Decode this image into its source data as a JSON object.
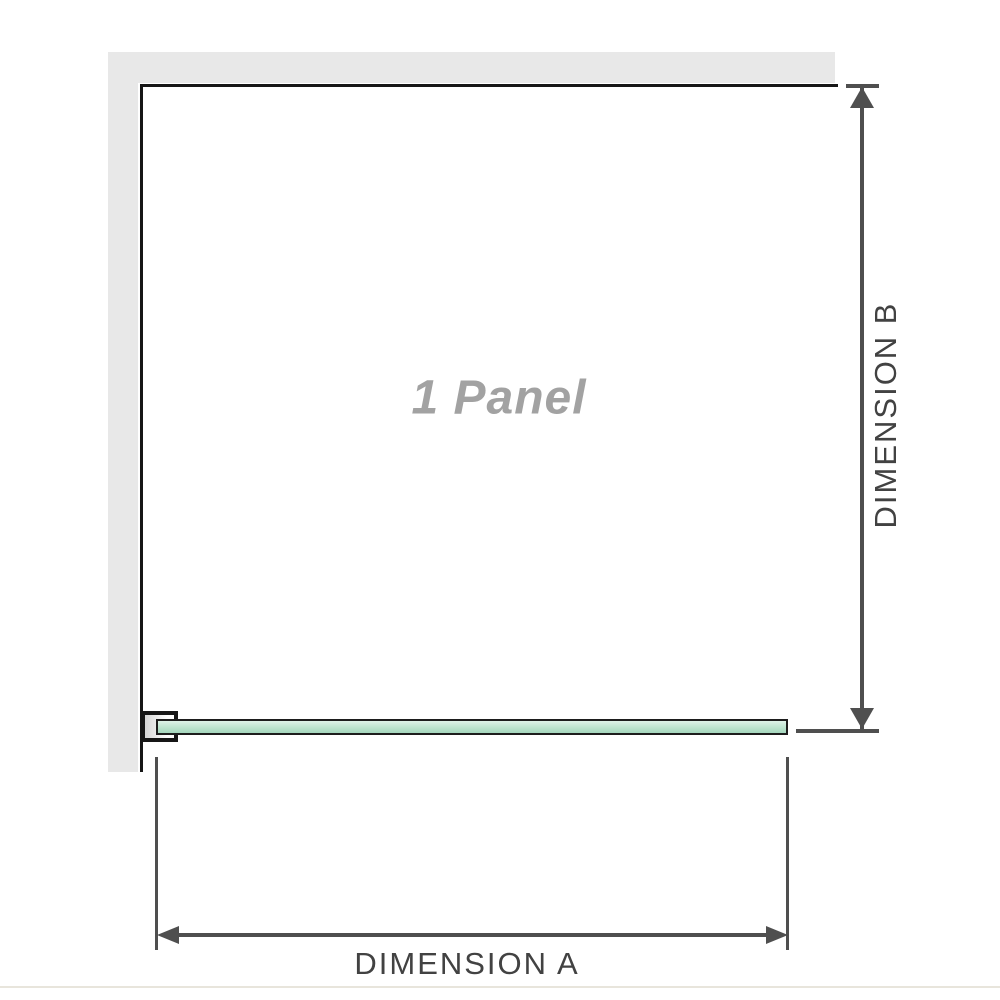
{
  "diagram": {
    "panel_label": "1 Panel",
    "dimension_a": {
      "label": "DIMENSION A"
    },
    "dimension_b": {
      "label": "DIMENSION B"
    }
  },
  "colors": {
    "wall_fill": "#e8e8e8",
    "outline": "#161616",
    "dimension_line": "#4f4f4f",
    "dimension_text": "#424242",
    "panel_text": "#a2a2a2",
    "glass_top": "#dff2e8",
    "glass_mid": "#c2e6d2",
    "glass_bottom": "#a5d7bd",
    "glass_border": "#1d1d1d",
    "bracket_fill_left": "#d6d6d6",
    "bracket_fill_right": "#fdfdfd",
    "photo_edge_line": "#e8e5dc"
  }
}
